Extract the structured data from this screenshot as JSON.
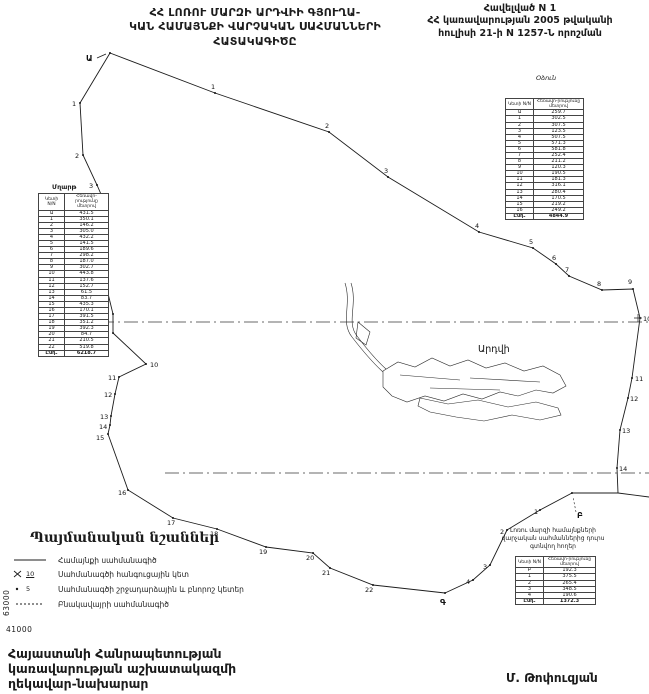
{
  "appendix": {
    "lines": [
      "Հավելված N 1",
      "ՀՀ կառավարության 2005 թվականի",
      "հուլիսի 21-ի N 1257-Ն որոշման"
    ]
  },
  "title": {
    "lines": [
      "ՀՀ ԼՈՌՈՒ ՄԱՐԶԻ ԱՐԴՎԻԻ ԳՅՈՒՂԱ-",
      "ԿԱՆ ՀԱՄԱՅՆՔԻ ՎԱՐՉԱԿԱՆ ՍԱՀՄԱՆՆԵՐԻ",
      "ՀԱՏԱԿԱԳԻԾԸ"
    ]
  },
  "tables": {
    "headers": {
      "point": "Կետի N/N",
      "distance": "Հեռավո-րությունը մետրով"
    },
    "mghart": {
      "name": "Մղարթ",
      "rows": [
        [
          "Ա",
          "431.5"
        ],
        [
          "1",
          "350.1"
        ],
        [
          "2",
          "146.2"
        ],
        [
          "3",
          "305.0"
        ],
        [
          "4",
          "432.2"
        ],
        [
          "5",
          "141.5"
        ],
        [
          "6",
          "189.6"
        ],
        [
          "7",
          "298.2"
        ],
        [
          "8",
          "187.0"
        ],
        [
          "9",
          "302.7"
        ],
        [
          "10",
          "443.8"
        ],
        [
          "11",
          "137.6"
        ],
        [
          "12",
          "152.7"
        ],
        [
          "13",
          "61.5"
        ],
        [
          "14",
          "83.7"
        ],
        [
          "15",
          "435.3"
        ],
        [
          "16",
          "170.1"
        ],
        [
          "17",
          "391.5"
        ],
        [
          "18",
          "351.2"
        ],
        [
          "19",
          "392.3"
        ],
        [
          "20",
          "84.7"
        ],
        [
          "21",
          "210.5"
        ],
        [
          "22",
          "519.8"
        ]
      ],
      "total_label": "Ընդ.",
      "total": "6218.7"
    },
    "odzun": {
      "name": "Օձուն",
      "rows": [
        [
          "Ա",
          "259.7"
        ],
        [
          "1",
          "302.5"
        ],
        [
          "2",
          "307.5"
        ],
        [
          "3",
          "123.5"
        ],
        [
          "4",
          "507.5"
        ],
        [
          "5",
          "571.3"
        ],
        [
          "6",
          "581.8"
        ],
        [
          "7",
          "252.4"
        ],
        [
          "8",
          "211.2"
        ],
        [
          "9",
          "120.3"
        ],
        [
          "10",
          "190.5"
        ],
        [
          "11",
          "181.3"
        ],
        [
          "12",
          "316.1"
        ],
        [
          "13",
          "280.4"
        ],
        [
          "14",
          "170.5"
        ],
        [
          "15",
          "219.2"
        ],
        [
          "16",
          "249.2"
        ]
      ],
      "total_label": "Ընդ.",
      "total": "4844.9"
    },
    "outside": {
      "title_lines": [
        "Լոռու մարզի համայնքների",
        "վարչական սահմաններից դուրս",
        "գտնվող հողեր"
      ],
      "rows": [
        [
          "Բ",
          "192.3"
        ],
        [
          "1",
          "375.5"
        ],
        [
          "2",
          "265.4"
        ],
        [
          "3",
          "348.5"
        ],
        [
          "4",
          "190.6"
        ]
      ],
      "total_label": "Ընդ.",
      "total": "1372.3"
    }
  },
  "legend": {
    "title": "Պայմանական նշաններ",
    "items": [
      {
        "label": "Համայնքի սահմանագիծ"
      },
      {
        "symbol_text": "10",
        "label": "Սահմանագծի հանգուցային կետ"
      },
      {
        "symbol_text": "5",
        "label": "Սահմանագծի շրջադարձային և բնորոշ կետեր"
      },
      {
        "label": "Բնակավայրի սահմանագիծ"
      }
    ]
  },
  "grid_labels": {
    "vertical": "63000",
    "horizontal": "41000"
  },
  "footer": {
    "lines": [
      "Հայաստանի Հանրապետության",
      "կառավարության աշխատակազմի",
      "ղեկավար-նախարար"
    ],
    "signature": "Մ. Թոփուզյան"
  },
  "map": {
    "area_label": {
      "text": "Արդվի",
      "x": 478,
      "y": 352
    },
    "paths": [
      {
        "name": "boundary-west-mghart",
        "style": "boundary",
        "d": "M110,53 L80,103 L83,155 L97,185 L107,208 L105,225 L103,243 L103,273 L113,314 L113,333 L146,364 L119,377 L115,394 L111,416 L110,425 L108,434 L128,490 L173,518 L217,529 L266,547 L313,553 L330,568 L373,585 L445,593"
      },
      {
        "name": "boundary-northeast-odzun",
        "style": "boundary",
        "d": "M110,53 L215,93 L329,132 L388,177 L479,232 L533,248 L556,264 L569,276 L602,290 L633,289 L640,318 L632,378 L628,398 L620,430 L617,468 L618,493 L572,493"
      },
      {
        "name": "boundary-southeast-outside",
        "style": "boundary",
        "d": "M445,593 L473,580 L490,565 L507,530 L540,510 L572,493"
      },
      {
        "name": "boundary-east-stub",
        "style": "boundary",
        "d": "M618,493 L649,497"
      },
      {
        "name": "grid-line-upper",
        "style": "grid",
        "d": "M100,322 L649,322"
      },
      {
        "name": "grid-line-lower",
        "style": "grid",
        "d": "M165,473 L649,473"
      },
      {
        "name": "grid-tick-cross",
        "style": "thin",
        "d": "M634,318 L642,318 M638,314 L638,322"
      },
      {
        "name": "village-stream-1",
        "style": "village",
        "d": "M345,283 C352,305 340,322 352,337 C362,350 372,362 383,372"
      },
      {
        "name": "village-stream-2",
        "style": "village",
        "d": "M351,283 C358,305 346,322 357,336 C366,348 376,360 386,369"
      },
      {
        "name": "village-block-upper",
        "style": "village",
        "d": "M383,371 L398,362 L415,367 L432,358 L450,366 L468,360 L486,368 L505,363 L524,371 L543,366 L560,375 L566,386 L553,393 L536,390 L518,396 L500,392 L482,399 L463,394 L444,401 L425,396 L407,402 L392,396 L383,387 Z"
      },
      {
        "name": "village-block-lower",
        "style": "village",
        "d": "M420,398 L448,404 L478,400 L508,407 L536,402 L558,408 L561,415 L540,420 L512,415 L484,421 L456,417 L430,412 L418,406 Z"
      },
      {
        "name": "village-inner-roads",
        "style": "village",
        "d": "M400,375 L460,380 M470,378 L540,382 M430,388 L500,390"
      },
      {
        "name": "village-west-patch",
        "style": "village",
        "d": "M358,322 L370,332 L366,345 L356,338 Z"
      },
      {
        "name": "point-a-arrow",
        "style": "thin",
        "d": "M97,58 L106,54"
      },
      {
        "name": "point-b-leader",
        "style": "leader",
        "d": "M576,512 L573,497"
      }
    ],
    "points": [
      {
        "label": "Ա",
        "big": true,
        "x": 110,
        "y": 53,
        "lx": 86,
        "ly": 61
      },
      {
        "label": "1",
        "x": 80,
        "y": 103,
        "lx": 72,
        "ly": 106
      },
      {
        "label": "2",
        "x": 83,
        "y": 155,
        "lx": 75,
        "ly": 158
      },
      {
        "label": "3",
        "x": 97,
        "y": 185,
        "lx": 89,
        "ly": 188
      },
      {
        "label": "4",
        "x": 107,
        "y": 208,
        "lx": 99,
        "ly": 211
      },
      {
        "label": "5",
        "x": 105,
        "y": 225,
        "lx": 96,
        "ly": 228
      },
      {
        "label": "6",
        "x": 103,
        "y": 243,
        "lx": 94,
        "ly": 246
      },
      {
        "label": "7",
        "x": 103,
        "y": 273,
        "lx": 94,
        "ly": 276
      },
      {
        "label": "8",
        "x": 113,
        "y": 314,
        "lx": 104,
        "ly": 317
      },
      {
        "label": "9",
        "x": 113,
        "y": 333,
        "lx": 104,
        "ly": 336
      },
      {
        "label": "10",
        "x": 146,
        "y": 364,
        "lx": 150,
        "ly": 367
      },
      {
        "label": "11",
        "x": 119,
        "y": 377,
        "lx": 108,
        "ly": 380
      },
      {
        "label": "12",
        "x": 115,
        "y": 394,
        "lx": 104,
        "ly": 397
      },
      {
        "label": "13",
        "x": 111,
        "y": 416,
        "lx": 100,
        "ly": 419
      },
      {
        "label": "14",
        "x": 110,
        "y": 425,
        "lx": 99,
        "ly": 429
      },
      {
        "label": "15",
        "x": 108,
        "y": 434,
        "lx": 96,
        "ly": 440
      },
      {
        "label": "16",
        "x": 128,
        "y": 490,
        "lx": 118,
        "ly": 495
      },
      {
        "label": "17",
        "x": 173,
        "y": 518,
        "lx": 167,
        "ly": 525
      },
      {
        "label": "18",
        "x": 217,
        "y": 529,
        "lx": 210,
        "ly": 536
      },
      {
        "label": "19",
        "x": 266,
        "y": 547,
        "lx": 259,
        "ly": 554
      },
      {
        "label": "20",
        "x": 313,
        "y": 553,
        "lx": 306,
        "ly": 560
      },
      {
        "label": "21",
        "x": 330,
        "y": 568,
        "lx": 322,
        "ly": 575
      },
      {
        "label": "22",
        "x": 373,
        "y": 585,
        "lx": 365,
        "ly": 592
      },
      {
        "label": "Գ",
        "big": true,
        "x": 445,
        "y": 593,
        "lx": 440,
        "ly": 605
      },
      {
        "label": "1",
        "x": 215,
        "y": 93,
        "lx": 211,
        "ly": 89
      },
      {
        "label": "2",
        "x": 329,
        "y": 132,
        "lx": 325,
        "ly": 128
      },
      {
        "label": "3",
        "x": 388,
        "y": 177,
        "lx": 384,
        "ly": 173
      },
      {
        "label": "4",
        "x": 479,
        "y": 232,
        "lx": 475,
        "ly": 228
      },
      {
        "label": "5",
        "x": 533,
        "y": 248,
        "lx": 529,
        "ly": 244
      },
      {
        "label": "6",
        "x": 556,
        "y": 264,
        "lx": 552,
        "ly": 260
      },
      {
        "label": "7",
        "x": 569,
        "y": 276,
        "lx": 565,
        "ly": 272
      },
      {
        "label": "8",
        "x": 602,
        "y": 290,
        "lx": 597,
        "ly": 286
      },
      {
        "label": "9",
        "x": 633,
        "y": 289,
        "lx": 628,
        "ly": 284
      },
      {
        "label": "10",
        "x": 640,
        "y": 318,
        "lx": 643,
        "ly": 321
      },
      {
        "label": "11",
        "x": 632,
        "y": 378,
        "lx": 635,
        "ly": 381
      },
      {
        "label": "12",
        "x": 628,
        "y": 398,
        "lx": 630,
        "ly": 401
      },
      {
        "label": "13",
        "x": 620,
        "y": 430,
        "lx": 622,
        "ly": 433
      },
      {
        "label": "14",
        "x": 617,
        "y": 468,
        "lx": 619,
        "ly": 471
      },
      {
        "label": "Բ",
        "big": true,
        "x": 572,
        "y": 493,
        "lx": 577,
        "ly": 518
      },
      {
        "label": "1",
        "x": 540,
        "y": 510,
        "lx": 534,
        "ly": 514
      },
      {
        "label": "2",
        "x": 507,
        "y": 530,
        "lx": 500,
        "ly": 534
      },
      {
        "label": "3",
        "x": 490,
        "y": 565,
        "lx": 483,
        "ly": 569
      },
      {
        "label": "4",
        "x": 473,
        "y": 580,
        "lx": 466,
        "ly": 584
      }
    ]
  }
}
